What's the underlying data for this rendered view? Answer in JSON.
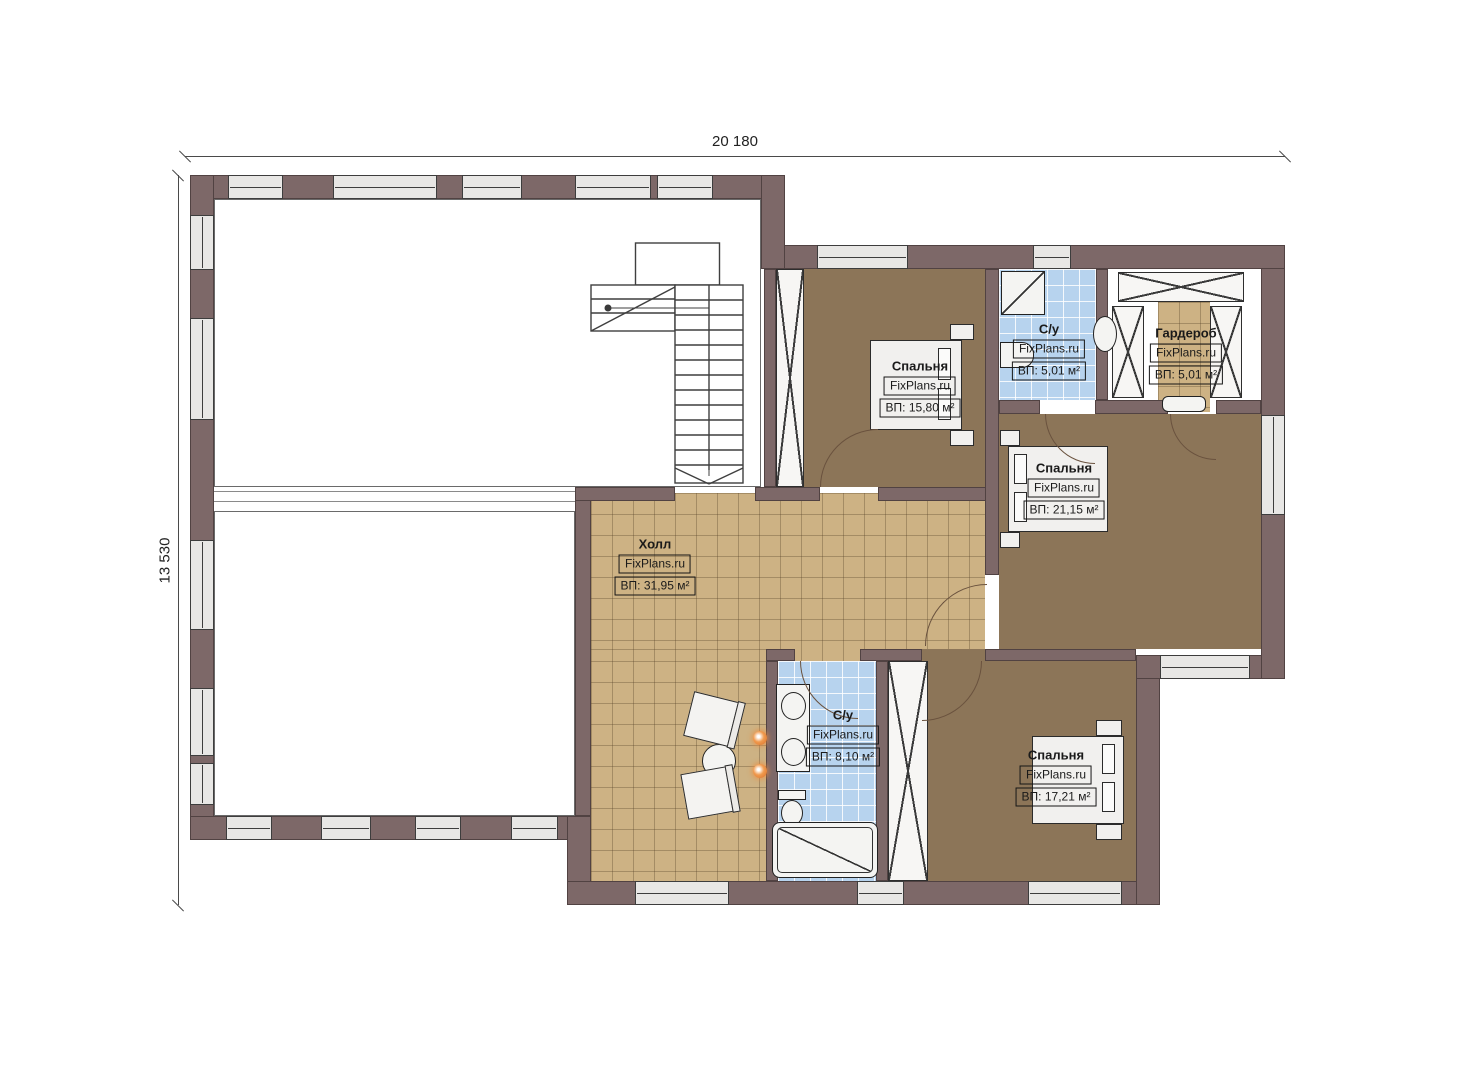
{
  "plan": {
    "dimension_top": "20 180",
    "dimension_left": "13 530",
    "brand": "FixPlans.ru"
  },
  "rooms": [
    {
      "name": "Спальня",
      "brand": "FixPlans.ru",
      "area": "ВП: 15,80 м²"
    },
    {
      "name": "С/у",
      "brand": "FixPlans.ru",
      "area": "ВП: 5,01 м²"
    },
    {
      "name": "Гардероб",
      "brand": "FixPlans.ru",
      "area": "ВП: 5,01 м²"
    },
    {
      "name": "Спальня",
      "brand": "FixPlans.ru",
      "area": "ВП: 21,15 м²"
    },
    {
      "name": "Холл",
      "brand": "FixPlans.ru",
      "area": "ВП: 31,95 м²"
    },
    {
      "name": "С/у",
      "brand": "FixPlans.ru",
      "area": "ВП: 8,10 м²"
    },
    {
      "name": "Спальня",
      "brand": "FixPlans.ru",
      "area": "ВП: 17,21 м²"
    }
  ],
  "colors": {
    "wall": "#7d6868",
    "window": "#e8e7e5",
    "floor_wood": "#8c7558",
    "floor_tile_tan": "#cdb284",
    "floor_tile_blue": "#b7d3ee",
    "sconce_accent": "#e8853c"
  }
}
